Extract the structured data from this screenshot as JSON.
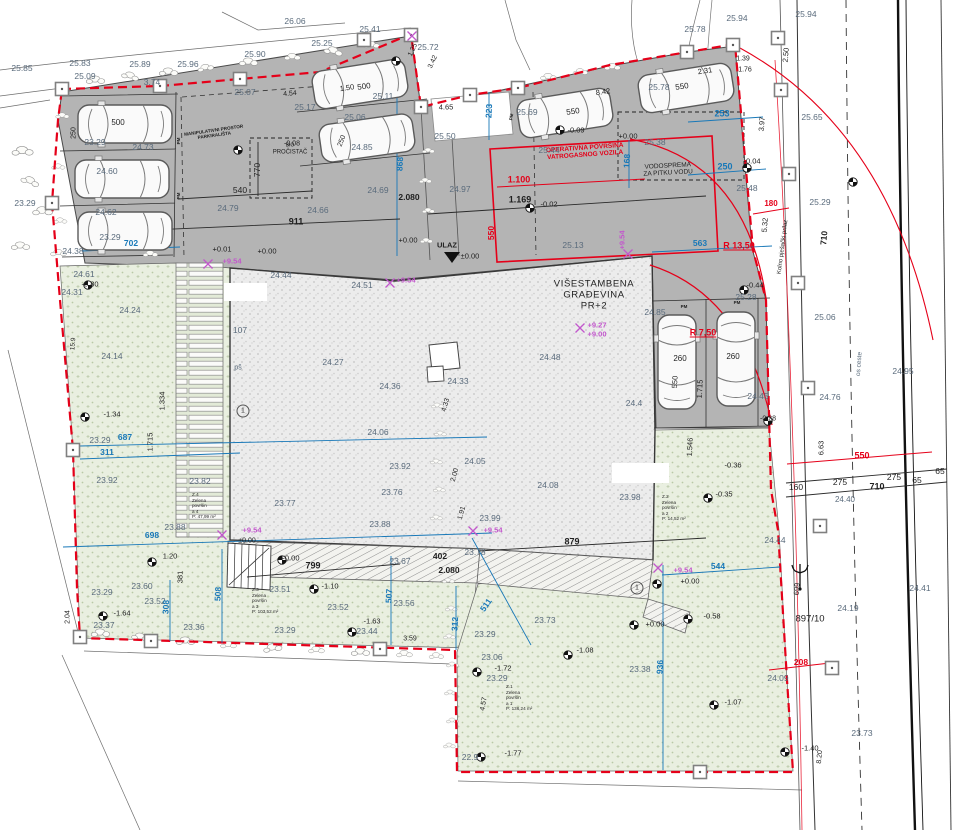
{
  "drawing": {
    "building_title": [
      "VIŠESTAMBENA",
      "GRAĐEVINA",
      "PR+2"
    ],
    "entrance_label": "ULAZ",
    "fire_area_label": [
      "OPERATIVNA POVRŠINA",
      "VATROGASNOG VOZILA"
    ],
    "water_tank_label": [
      "VODOSPREMA",
      "ZA PITKU VODU"
    ],
    "purifier_label": [
      "BIO",
      "PROČISTAČ"
    ],
    "maneuver_label": [
      "MANIPULATIVNI PROSTOR",
      "PARKIRALIŠTA"
    ],
    "parcel_number": "897/10",
    "road_axis_label": "os ceste",
    "access_label": "Kolno pješački prilaz"
  },
  "zones": [
    {
      "x": 506,
      "y": 698,
      "lines": [
        "Z.1",
        "Zelena",
        "površin",
        "a 1",
        "P: 136,24 m²"
      ]
    },
    {
      "x": 662,
      "y": 508,
      "lines": [
        "Z.2",
        "Zelena",
        "površin",
        "a 2",
        "P: 14,52 m²"
      ]
    },
    {
      "x": 252,
      "y": 601,
      "lines": [
        "Z.3",
        "Zelena",
        "površin",
        "a 3",
        "P: 103,52 m²"
      ]
    },
    {
      "x": 192,
      "y": 506,
      "lines": [
        "Z.4",
        "Zelena",
        "površin",
        "a 4",
        "P: 47,99 m²"
      ]
    }
  ],
  "colors": {
    "boundary": "#e50019",
    "dim_blue": "#1878b8",
    "magenta": "#c257cc",
    "pavement": "#b4b4b4",
    "green": "#e9efe0",
    "building": "#ececec"
  },
  "labels": [
    {
      "t": "25.85",
      "x": 22,
      "y": 68
    },
    {
      "t": "25.83",
      "x": 80,
      "y": 63
    },
    {
      "t": "25.89",
      "x": 140,
      "y": 64
    },
    {
      "t": "25.96",
      "x": 188,
      "y": 64
    },
    {
      "t": "25.09",
      "x": 85,
      "y": 76
    },
    {
      "t": "25.90",
      "x": 255,
      "y": 54
    },
    {
      "t": "26.06",
      "x": 295,
      "y": 21
    },
    {
      "t": "25.41",
      "x": 370,
      "y": 29
    },
    {
      "t": "25.25",
      "x": 322,
      "y": 43
    },
    {
      "t": "25.72",
      "x": 428,
      "y": 47
    },
    {
      "t": "23.29",
      "x": 25,
      "y": 203
    },
    {
      "t": "25.78",
      "x": 695,
      "y": 29
    },
    {
      "t": "25.94",
      "x": 737,
      "y": 18
    },
    {
      "t": "25.94",
      "x": 806,
      "y": 14
    },
    {
      "t": "25.65",
      "x": 812,
      "y": 117
    },
    {
      "t": "25.29",
      "x": 820,
      "y": 202
    },
    {
      "t": "25.06",
      "x": 825,
      "y": 317
    },
    {
      "t": "24.76",
      "x": 830,
      "y": 397
    },
    {
      "t": "24.95",
      "x": 903,
      "y": 371
    },
    {
      "t": "24.41",
      "x": 920,
      "y": 588
    },
    {
      "t": "24.19",
      "x": 848,
      "y": 608
    },
    {
      "t": "23.73",
      "x": 862,
      "y": 733
    },
    {
      "t": "24.44",
      "x": 775,
      "y": 540
    },
    {
      "t": "24.09",
      "x": 778,
      "y": 678
    },
    {
      "t": "25.13",
      "x": 573,
      "y": 245
    },
    {
      "t": "25.48",
      "x": 747,
      "y": 188
    },
    {
      "t": "25.28",
      "x": 746,
      "y": 297
    },
    {
      "t": "25.38",
      "x": 655,
      "y": 142
    },
    {
      "t": "25.44",
      "x": 549,
      "y": 150
    },
    {
      "t": "25.17",
      "x": 305,
      "y": 107
    },
    {
      "t": "25.07",
      "x": 245,
      "y": 92
    },
    {
      "t": "3.74",
      "x": 152,
      "y": 82
    },
    {
      "t": "24.79",
      "x": 228,
      "y": 208
    },
    {
      "t": "24.66",
      "x": 318,
      "y": 210
    },
    {
      "t": "24.69",
      "x": 378,
      "y": 190
    },
    {
      "t": "24.97",
      "x": 460,
      "y": 189
    },
    {
      "t": "25.69",
      "x": 527,
      "y": 112
    },
    {
      "t": "25.78",
      "x": 659,
      "y": 87
    },
    {
      "t": "25.50",
      "x": 445,
      "y": 136
    },
    {
      "t": "24.85",
      "x": 362,
      "y": 147
    },
    {
      "t": "25.06",
      "x": 355,
      "y": 117
    },
    {
      "t": "25.11",
      "x": 383,
      "y": 96
    },
    {
      "t": "24.60",
      "x": 107,
      "y": 171
    },
    {
      "t": "24.62",
      "x": 106,
      "y": 212
    },
    {
      "t": "23.29",
      "x": 110,
      "y": 237
    },
    {
      "t": "23.29",
      "x": 95,
      "y": 142
    },
    {
      "t": "24.73",
      "x": 143,
      "y": 147
    },
    {
      "t": "24.38",
      "x": 73,
      "y": 251
    },
    {
      "t": "24.61",
      "x": 84,
      "y": 274
    },
    {
      "t": "24.31",
      "x": 72,
      "y": 292
    },
    {
      "t": "24.24",
      "x": 130,
      "y": 310
    },
    {
      "t": "24.14",
      "x": 112,
      "y": 356
    },
    {
      "t": "23.29",
      "x": 100,
      "y": 440
    },
    {
      "t": "23.92",
      "x": 107,
      "y": 480
    },
    {
      "t": "23.82",
      "x": 200,
      "y": 481
    },
    {
      "t": "24.44",
      "x": 281,
      "y": 275
    },
    {
      "t": "24.51",
      "x": 362,
      "y": 285
    },
    {
      "t": "107",
      "x": 240,
      "y": 330
    },
    {
      "t": "pš",
      "x": 238,
      "y": 368,
      "s": 7
    },
    {
      "t": "24.27",
      "x": 333,
      "y": 362
    },
    {
      "t": "24.36",
      "x": 390,
      "y": 386
    },
    {
      "t": "24.33",
      "x": 458,
      "y": 381
    },
    {
      "t": "24.48",
      "x": 550,
      "y": 357
    },
    {
      "t": "24.06",
      "x": 378,
      "y": 432
    },
    {
      "t": "23.92",
      "x": 400,
      "y": 466
    },
    {
      "t": "23.77",
      "x": 285,
      "y": 503
    },
    {
      "t": "23.76",
      "x": 392,
      "y": 492
    },
    {
      "t": "23.88",
      "x": 380,
      "y": 524
    },
    {
      "t": "24.05",
      "x": 475,
      "y": 461
    },
    {
      "t": "24.08",
      "x": 548,
      "y": 485
    },
    {
      "t": "23.98",
      "x": 630,
      "y": 497
    },
    {
      "t": "23.99",
      "x": 490,
      "y": 518
    },
    {
      "t": "24.4",
      "x": 634,
      "y": 403
    },
    {
      "t": "24.45",
      "x": 758,
      "y": 396
    },
    {
      "t": "23.60",
      "x": 142,
      "y": 586
    },
    {
      "t": "23.29",
      "x": 102,
      "y": 592
    },
    {
      "t": "23.37",
      "x": 104,
      "y": 625
    },
    {
      "t": "23.52",
      "x": 155,
      "y": 601
    },
    {
      "t": "23.36",
      "x": 194,
      "y": 627
    },
    {
      "t": "23.51",
      "x": 280,
      "y": 589
    },
    {
      "t": "23.52",
      "x": 338,
      "y": 607
    },
    {
      "t": "23.44",
      "x": 367,
      "y": 631
    },
    {
      "t": "23.29",
      "x": 285,
      "y": 630
    },
    {
      "t": "23.56",
      "x": 404,
      "y": 603
    },
    {
      "t": "23.67",
      "x": 400,
      "y": 561
    },
    {
      "t": "23.78",
      "x": 475,
      "y": 552
    },
    {
      "t": "23.73",
      "x": 545,
      "y": 620
    },
    {
      "t": "23.06",
      "x": 492,
      "y": 657
    },
    {
      "t": "23.29",
      "x": 497,
      "y": 678
    },
    {
      "t": "23.38",
      "x": 640,
      "y": 669
    },
    {
      "t": "22.9",
      "x": 470,
      "y": 757
    },
    {
      "t": "24.85",
      "x": 655,
      "y": 312
    },
    {
      "t": "23.29",
      "x": 485,
      "y": 634
    },
    {
      "t": "24.40",
      "x": 845,
      "y": 500,
      "s": 8
    },
    {
      "t": "23.88",
      "x": 175,
      "y": 527
    },
    {
      "t": "-0.09",
      "x": 576,
      "y": 130,
      "c": "blk",
      "s": 7.5
    },
    {
      "t": "-0.04",
      "x": 752,
      "y": 161,
      "c": "blk",
      "s": 7.5
    },
    {
      "t": "-0.02",
      "x": 549,
      "y": 204,
      "c": "blk",
      "s": 7.5
    },
    {
      "t": "-0.08",
      "x": 292,
      "y": 144,
      "c": "blk",
      "s": 7
    },
    {
      "t": "-0.80",
      "x": 90,
      "y": 284,
      "c": "blk",
      "s": 7.5
    },
    {
      "t": "-1.34",
      "x": 112,
      "y": 414,
      "c": "blk",
      "s": 7.5
    },
    {
      "t": "-1.64",
      "x": 122,
      "y": 613,
      "c": "blk",
      "s": 7.5
    },
    {
      "t": "-1.10",
      "x": 330,
      "y": 586,
      "c": "blk",
      "s": 7.5
    },
    {
      "t": "-1.63",
      "x": 372,
      "y": 621,
      "c": "blk",
      "s": 7.5
    },
    {
      "t": "-1.08",
      "x": 585,
      "y": 650,
      "c": "blk",
      "s": 7.5
    },
    {
      "t": "-1.72",
      "x": 503,
      "y": 668,
      "c": "blk",
      "s": 7.5
    },
    {
      "t": "-1.07",
      "x": 733,
      "y": 702,
      "c": "blk",
      "s": 7.5
    },
    {
      "t": "-1.77",
      "x": 513,
      "y": 753,
      "c": "blk",
      "s": 7.5
    },
    {
      "t": "-1.40",
      "x": 810,
      "y": 748,
      "c": "blk",
      "s": 7.5
    },
    {
      "t": "+0.00",
      "x": 655,
      "y": 624,
      "c": "blk",
      "s": 7.5
    },
    {
      "t": "-0.58",
      "x": 712,
      "y": 616,
      "c": "blk",
      "s": 7.5
    },
    {
      "t": "-0.35",
      "x": 724,
      "y": 494,
      "c": "blk",
      "s": 7.5
    },
    {
      "t": "-0.36",
      "x": 733,
      "y": 465,
      "c": "blk",
      "s": 7.5
    },
    {
      "t": "-0.44",
      "x": 755,
      "y": 285,
      "c": "blk",
      "s": 7.5
    },
    {
      "t": "-0.28",
      "x": 768,
      "y": 419,
      "c": "blk",
      "s": 7
    },
    {
      "t": "+0.00",
      "x": 290,
      "y": 558,
      "c": "blk",
      "s": 7.5
    },
    {
      "t": "+0.01",
      "x": 222,
      "y": 249,
      "c": "blk",
      "s": 7.5
    },
    {
      "t": "+0.00",
      "x": 267,
      "y": 251,
      "c": "blk",
      "s": 7.5
    },
    {
      "t": "±0.00",
      "x": 470,
      "y": 256,
      "c": "blk",
      "s": 7.5
    },
    {
      "t": "+0.00",
      "x": 408,
      "y": 240,
      "c": "blk",
      "s": 7.5
    },
    {
      "t": "+0.00",
      "x": 690,
      "y": 581,
      "c": "blk",
      "s": 7.5
    },
    {
      "t": "±0.00",
      "x": 247,
      "y": 541,
      "c": "blk",
      "s": 7
    },
    {
      "t": "+0.00",
      "x": 628,
      "y": 136,
      "c": "blk",
      "s": 7.5
    },
    {
      "t": "2.04",
      "x": 68,
      "y": 617,
      "c": "blk",
      "s": 7,
      "r": -90
    },
    {
      "t": "15.9",
      "x": 74,
      "y": 344,
      "c": "blk",
      "s": 6.5,
      "r": -85
    },
    {
      "t": "1.334",
      "x": 162,
      "y": 401,
      "c": "blk",
      "s": 7.5,
      "r": -90
    },
    {
      "t": "1.715",
      "x": 150,
      "y": 442,
      "c": "blk",
      "s": 7.5,
      "r": -90
    },
    {
      "t": "381",
      "x": 180,
      "y": 577,
      "c": "blk",
      "s": 7.5,
      "r": -90
    },
    {
      "t": "1.20",
      "x": 170,
      "y": 556,
      "c": "blk",
      "s": 7.5
    },
    {
      "t": "3.59",
      "x": 410,
      "y": 639,
      "c": "blk",
      "s": 7
    },
    {
      "t": "4.57",
      "x": 484,
      "y": 704,
      "c": "blk",
      "s": 7,
      "r": -80
    },
    {
      "t": "4.33",
      "x": 446,
      "y": 405,
      "c": "blk",
      "s": 7,
      "r": -75
    },
    {
      "t": "2.00",
      "x": 455,
      "y": 475,
      "c": "blk",
      "s": 7,
      "r": -75
    },
    {
      "t": "1.91",
      "x": 462,
      "y": 513,
      "c": "blk",
      "s": 7,
      "r": -75
    },
    {
      "t": "1.546",
      "x": 690,
      "y": 447,
      "c": "blk",
      "s": 7.5,
      "r": -87
    },
    {
      "t": "1.715",
      "x": 700,
      "y": 389,
      "c": "blk",
      "s": 7.5,
      "r": -87
    },
    {
      "t": "550",
      "x": 675,
      "y": 382,
      "c": "blk",
      "s": 7.5,
      "r": -87
    },
    {
      "t": "260",
      "x": 680,
      "y": 359,
      "c": "blk",
      "s": 8
    },
    {
      "t": "260",
      "x": 733,
      "y": 357,
      "c": "blk",
      "s": 8
    },
    {
      "t": "250",
      "x": 74,
      "y": 133,
      "c": "blk",
      "s": 7,
      "r": -90
    },
    {
      "t": "250",
      "x": 342,
      "y": 141,
      "c": "blk",
      "s": 7,
      "r": -70
    },
    {
      "t": "500",
      "x": 118,
      "y": 123,
      "c": "blk",
      "s": 8
    },
    {
      "t": "1.50",
      "x": 347,
      "y": 88,
      "c": "blk",
      "s": 7.5,
      "r": -8
    },
    {
      "t": "500",
      "x": 364,
      "y": 87,
      "c": "blk",
      "s": 8,
      "r": -8
    },
    {
      "t": "550",
      "x": 573,
      "y": 112,
      "c": "blk",
      "s": 8,
      "r": -8
    },
    {
      "t": "550",
      "x": 682,
      "y": 87,
      "c": "blk",
      "s": 8,
      "r": -8
    },
    {
      "t": "2.31",
      "x": 705,
      "y": 71,
      "c": "blk",
      "s": 7.5,
      "r": -8
    },
    {
      "t": "8.42",
      "x": 603,
      "y": 92,
      "c": "blk",
      "s": 7.5,
      "r": -8
    },
    {
      "t": "1.39",
      "x": 743,
      "y": 59,
      "c": "blk",
      "s": 7
    },
    {
      "t": "1.76",
      "x": 745,
      "y": 70,
      "c": "blk",
      "s": 7
    },
    {
      "t": "4.65",
      "x": 446,
      "y": 107,
      "c": "blk",
      "s": 7.5
    },
    {
      "t": "1.25",
      "x": 413,
      "y": 50,
      "c": "blk",
      "s": 7,
      "r": -65
    },
    {
      "t": "3.42",
      "x": 433,
      "y": 62,
      "c": "blk",
      "s": 7,
      "r": -65
    },
    {
      "t": "2.50",
      "x": 786,
      "y": 55,
      "c": "blk",
      "s": 7.5,
      "r": -85
    },
    {
      "t": "3.97",
      "x": 762,
      "y": 124,
      "c": "blk",
      "s": 7.5,
      "r": -85
    },
    {
      "t": "5.32",
      "x": 765,
      "y": 225,
      "c": "blk",
      "s": 7.5,
      "r": -85
    },
    {
      "t": "710",
      "x": 824,
      "y": 238,
      "c": "blk",
      "s": 8.5,
      "r": -85,
      "b": 1
    },
    {
      "t": "699",
      "x": 797,
      "y": 589,
      "c": "blk",
      "s": 7.5,
      "r": -85
    },
    {
      "t": "8.20",
      "x": 820,
      "y": 757,
      "c": "blk",
      "s": 7,
      "r": -85
    },
    {
      "t": "6.63",
      "x": 821,
      "y": 448,
      "c": "blk",
      "s": 7.5,
      "r": -90
    },
    {
      "t": "160",
      "x": 796,
      "y": 487,
      "c": "blk",
      "s": 8.5
    },
    {
      "t": "275",
      "x": 840,
      "y": 482,
      "c": "blk",
      "s": 8.5
    },
    {
      "t": "275",
      "x": 894,
      "y": 477,
      "c": "blk",
      "s": 8.5
    },
    {
      "t": "65",
      "x": 917,
      "y": 480,
      "c": "blk",
      "s": 8.5
    },
    {
      "t": "65",
      "x": 940,
      "y": 471,
      "c": "blk",
      "s": 8.5
    },
    {
      "t": "710",
      "x": 877,
      "y": 487,
      "c": "blk",
      "s": 9,
      "b": 1
    },
    {
      "t": "911",
      "x": 296,
      "y": 222,
      "c": "blk",
      "s": 9,
      "b": 1
    },
    {
      "t": "540",
      "x": 240,
      "y": 190,
      "c": "blk",
      "s": 8.5
    },
    {
      "t": "770",
      "x": 257,
      "y": 170,
      "c": "blk",
      "s": 8.5,
      "r": -90
    },
    {
      "t": "4.54",
      "x": 290,
      "y": 94,
      "c": "blk",
      "s": 7,
      "r": -5
    },
    {
      "t": "1.169",
      "x": 520,
      "y": 200,
      "c": "blk",
      "s": 9,
      "b": 1
    },
    {
      "t": "2.080",
      "x": 409,
      "y": 197,
      "c": "blk",
      "s": 8.5,
      "b": 1
    },
    {
      "t": "402",
      "x": 440,
      "y": 556,
      "c": "blk",
      "s": 8.5,
      "b": 1
    },
    {
      "t": "2.080",
      "x": 449,
      "y": 570,
      "c": "blk",
      "s": 8.5,
      "b": 1
    },
    {
      "t": "879",
      "x": 572,
      "y": 542,
      "c": "blk",
      "s": 9,
      "b": 1
    },
    {
      "t": "799",
      "x": 313,
      "y": 566,
      "c": "blk",
      "s": 9,
      "b": 1
    },
    {
      "t": "PM",
      "x": 179,
      "y": 141,
      "c": "blk",
      "s": 4.5,
      "r": -90,
      "b": 1
    },
    {
      "t": "PM",
      "x": 179,
      "y": 196,
      "c": "blk",
      "s": 4.5,
      "r": -90,
      "b": 1
    },
    {
      "t": "PM",
      "x": 512,
      "y": 117,
      "c": "blk",
      "s": 4.5,
      "r": -80,
      "b": 1
    },
    {
      "t": "PM",
      "x": 684,
      "y": 307,
      "c": "blk",
      "s": 4.5,
      "b": 1
    },
    {
      "t": "PM",
      "x": 737,
      "y": 303,
      "c": "blk",
      "s": 4.5,
      "b": 1
    },
    {
      "t": "702",
      "x": 131,
      "y": 243,
      "c": "blu"
    },
    {
      "t": "868",
      "x": 400,
      "y": 164,
      "c": "blu",
      "r": -87
    },
    {
      "t": "223",
      "x": 489,
      "y": 111,
      "c": "blu",
      "r": -87
    },
    {
      "t": "253",
      "x": 722,
      "y": 114,
      "c": "blu",
      "s": 9
    },
    {
      "t": "250",
      "x": 725,
      "y": 167,
      "c": "blu",
      "s": 9
    },
    {
      "t": "168",
      "x": 627,
      "y": 161,
      "c": "blu",
      "r": -87
    },
    {
      "t": "563",
      "x": 700,
      "y": 243,
      "c": "blu"
    },
    {
      "t": "687",
      "x": 125,
      "y": 437,
      "c": "blu"
    },
    {
      "t": "311",
      "x": 107,
      "y": 452,
      "c": "blu"
    },
    {
      "t": "698",
      "x": 152,
      "y": 535,
      "c": "blu"
    },
    {
      "t": "508",
      "x": 218,
      "y": 594,
      "c": "blu",
      "r": -87
    },
    {
      "t": "308",
      "x": 166,
      "y": 607,
      "c": "blu",
      "r": -87
    },
    {
      "t": "507",
      "x": 389,
      "y": 596,
      "c": "blu",
      "r": -87
    },
    {
      "t": "511",
      "x": 486,
      "y": 605,
      "c": "blu",
      "r": -55
    },
    {
      "t": "312",
      "x": 455,
      "y": 624,
      "c": "blu",
      "r": -87
    },
    {
      "t": "544",
      "x": 718,
      "y": 566,
      "c": "blu"
    },
    {
      "t": "936",
      "x": 660,
      "y": 667,
      "c": "blu",
      "r": -87
    },
    {
      "t": "1.100",
      "x": 519,
      "y": 180,
      "c": "red",
      "s": 9,
      "b": 1
    },
    {
      "t": "550",
      "x": 491,
      "y": 233,
      "c": "red",
      "r": -90,
      "b": 1
    },
    {
      "t": "180",
      "x": 771,
      "y": 204,
      "c": "red",
      "s": 8,
      "b": 1
    },
    {
      "t": "550",
      "x": 862,
      "y": 456,
      "c": "red",
      "s": 9,
      "b": 1
    },
    {
      "t": "208",
      "x": 801,
      "y": 662,
      "c": "red",
      "b": 1
    },
    {
      "t": "R 13,50",
      "x": 739,
      "y": 246,
      "c": "red",
      "s": 9,
      "b": 1,
      "u": 1
    },
    {
      "t": "R 7,50",
      "x": 703,
      "y": 333,
      "c": "red",
      "s": 9,
      "b": 1,
      "u": 1
    },
    {
      "t": "+9.54",
      "x": 232,
      "y": 261,
      "c": "mag",
      "s": 7.5
    },
    {
      "t": "+9.54",
      "x": 622,
      "y": 240,
      "c": "mag",
      "s": 7.5,
      "r": -90
    },
    {
      "t": "+9.54",
      "x": 493,
      "y": 530,
      "c": "mag",
      "s": 7.5
    },
    {
      "t": "+9.54",
      "x": 252,
      "y": 530,
      "c": "mag",
      "s": 7.5
    },
    {
      "t": "+9.54",
      "x": 683,
      "y": 570,
      "c": "mag",
      "s": 7.5
    },
    {
      "t": "+9.54",
      "x": 406,
      "y": 280,
      "c": "mag",
      "s": 7.5
    },
    {
      "t": "+9.27",
      "x": 597,
      "y": 325,
      "c": "mag",
      "s": 7.5
    },
    {
      "t": "+9.00",
      "x": 597,
      "y": 334,
      "c": "mag",
      "s": 7.5
    },
    {
      "t": "1",
      "x": 243,
      "y": 411,
      "c": "circ",
      "s": 7
    },
    {
      "t": "1",
      "x": 637,
      "y": 588,
      "c": "circ",
      "s": 7
    }
  ]
}
